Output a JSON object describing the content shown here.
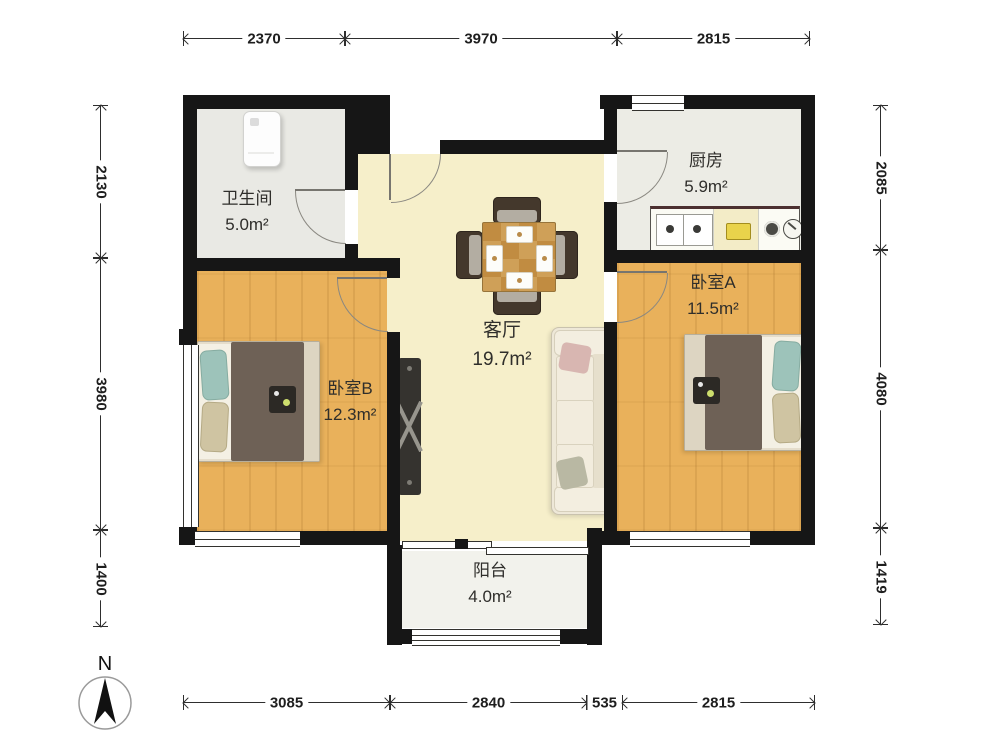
{
  "plan": {
    "rooms": {
      "bathroom": {
        "name": "卫生间",
        "area": "5.0m²"
      },
      "kitchen": {
        "name": "厨房",
        "area": "5.9m²"
      },
      "living": {
        "name": "客厅",
        "area": "19.7m²"
      },
      "bedroomA": {
        "name": "卧室A",
        "area": "11.5m²"
      },
      "bedroomB": {
        "name": "卧室B",
        "area": "12.3m²"
      },
      "balcony": {
        "name": "阳台",
        "area": "4.0m²"
      }
    },
    "dimensions": {
      "top": [
        {
          "label": "2370"
        },
        {
          "label": "3970"
        },
        {
          "label": "2815"
        }
      ],
      "bottom": [
        {
          "label": "3085"
        },
        {
          "label": "2840"
        },
        {
          "label": "535"
        },
        {
          "label": "2815"
        }
      ],
      "left": [
        {
          "label": "2130"
        },
        {
          "label": "3980"
        },
        {
          "label": "1400"
        }
      ],
      "right": [
        {
          "label": "2085"
        },
        {
          "label": "4080"
        },
        {
          "label": "1419"
        }
      ]
    },
    "compass": {
      "label": "N"
    },
    "colors": {
      "wall": "#161616",
      "wood_floor": "#e9b15b",
      "living_floor": "#f6efca",
      "tile_floor": "#e9e9e4",
      "balcony_floor": "#f2f2ec"
    }
  }
}
